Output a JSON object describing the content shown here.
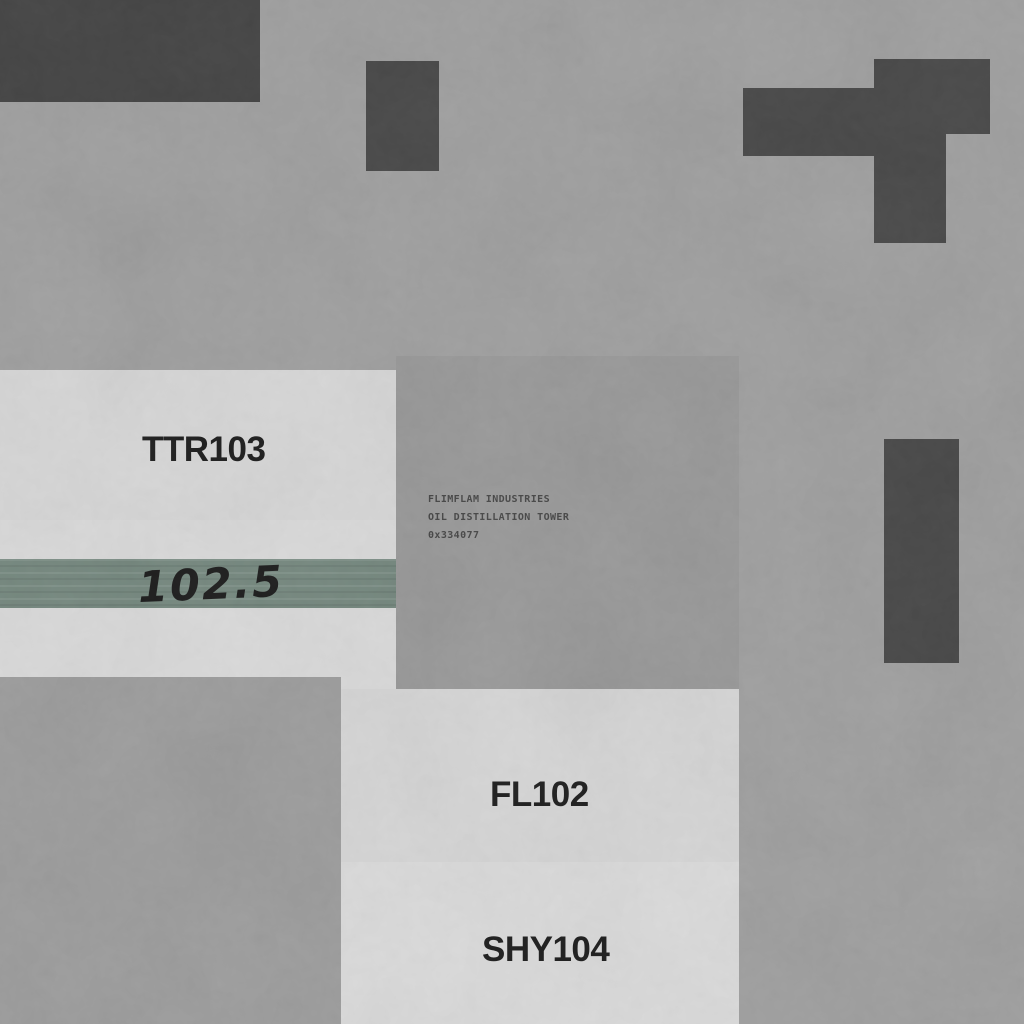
{
  "scene": {
    "units": {
      "ttr": {
        "label": "TTR103"
      },
      "fl": {
        "label": "FL102"
      },
      "shy": {
        "label": "SHY104"
      }
    },
    "gauge": {
      "value": "102.5"
    },
    "plaque": {
      "line1": "FLIMFLAM INDUSTRIES",
      "line2": "OIL DISTILLATION TOWER",
      "line3": "0x334077"
    },
    "colors": {
      "background": "#9b9b9b",
      "light_panel": "#d6d6d6",
      "middle_panel": "#949494",
      "dark_block": "#3d3d3d",
      "green_stripe": "#6d8177",
      "label_text": "#0f0f0f",
      "plaque_text": "#3b3b3b"
    }
  }
}
